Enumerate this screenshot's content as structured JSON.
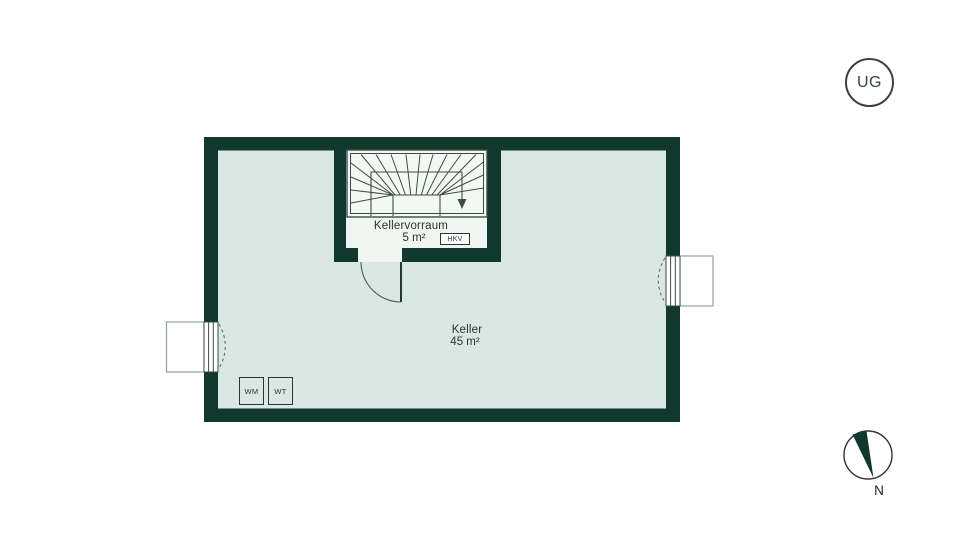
{
  "colors": {
    "wall": "#11382c",
    "keller_floor": "#d9e8e2",
    "vorraum_floor": "#f0f5f1",
    "stair_fill": "#f4f8f5",
    "line": "#3c4d45",
    "text": "#27352f"
  },
  "floor_plan": {
    "level_badge": "UG",
    "rooms": [
      {
        "name": "Kellervorraum",
        "area": "5 m²"
      },
      {
        "name": "Keller",
        "area": "45 m²"
      }
    ],
    "equipment": {
      "hkv": "HKV",
      "washing_machine": "WM",
      "dryer": "WT"
    },
    "compass": {
      "north": "N"
    }
  }
}
